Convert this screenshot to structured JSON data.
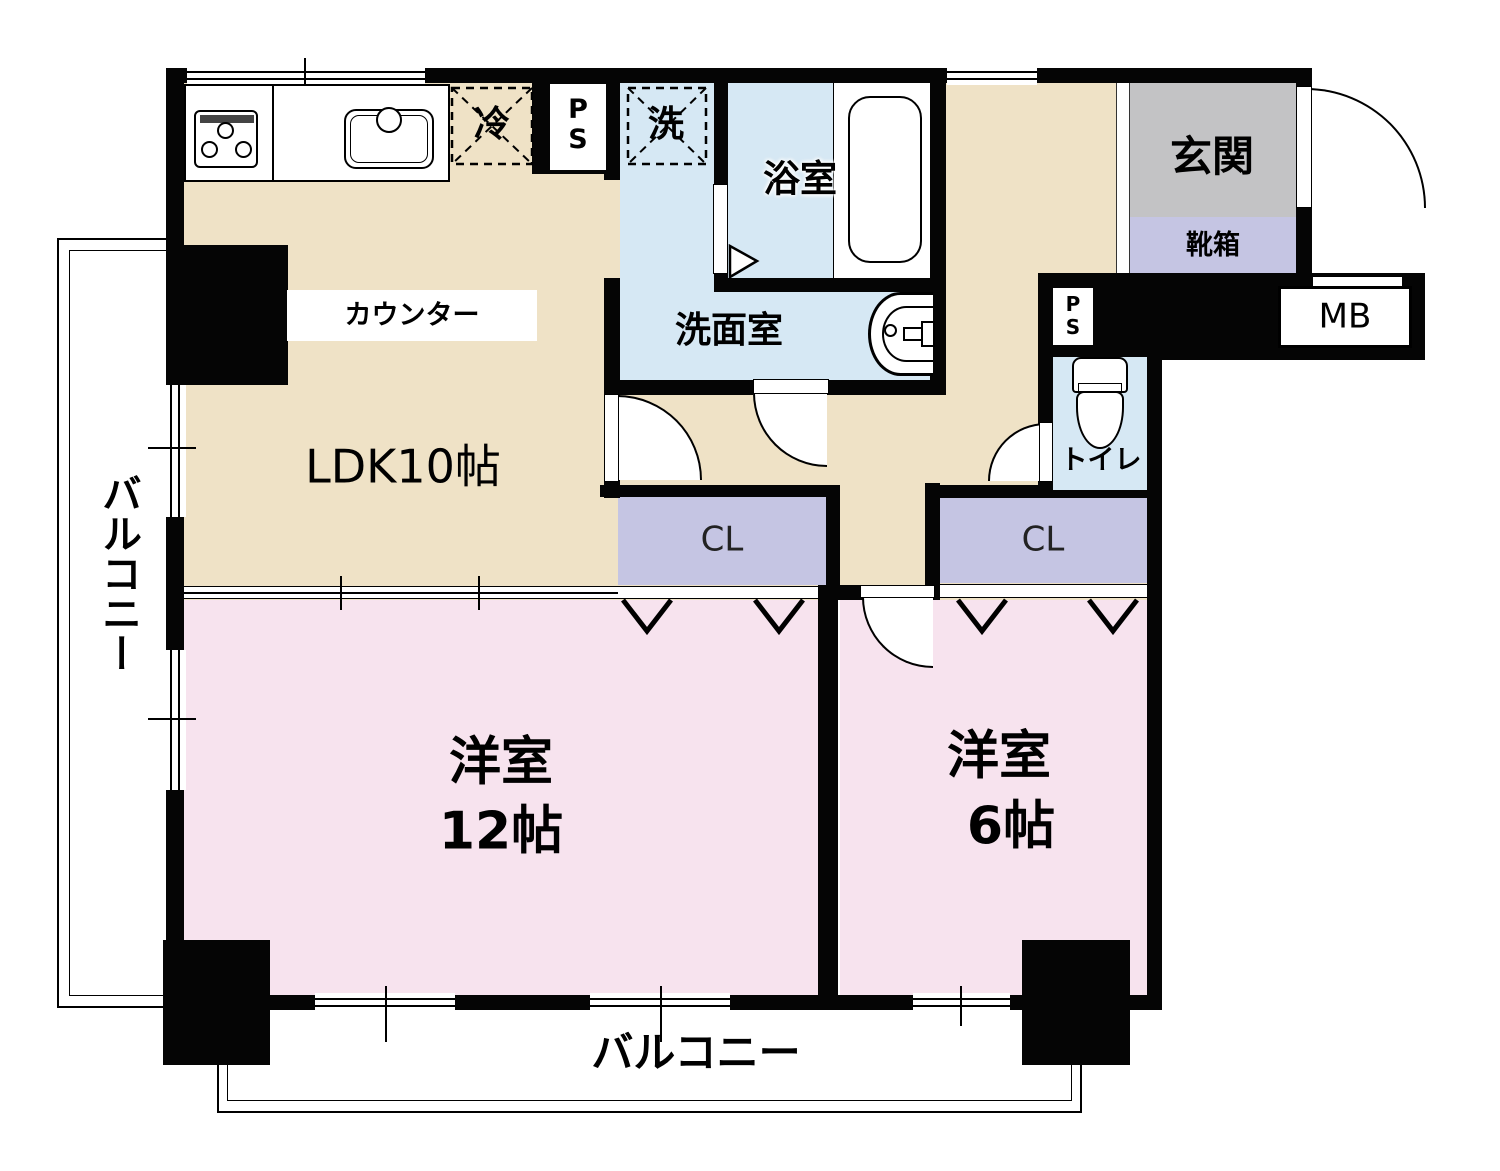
{
  "rooms": {
    "ldk": {
      "label": "LDK10帖"
    },
    "western_12": {
      "line1": "洋室",
      "line2": "12帖"
    },
    "western_6": {
      "line1": "洋室",
      "line2": "6帖"
    },
    "bath": {
      "label": "浴室"
    },
    "washroom": {
      "label": "洗面室"
    },
    "toilet": {
      "label": "トイレ"
    },
    "entrance": {
      "label": "玄関"
    },
    "shoe_box": {
      "label": "靴箱"
    },
    "closet_left": {
      "label": "CL"
    },
    "closet_right": {
      "label": "CL"
    },
    "balcony_left": {
      "label": "バルコニー"
    },
    "balcony_bottom": {
      "label": "バルコニー"
    }
  },
  "fixtures": {
    "counter": {
      "label": "カウンター"
    },
    "refrigerator": {
      "label": "冷"
    },
    "washer": {
      "label": "洗"
    },
    "pipe_space_kitchen": {
      "line1": "P",
      "line2": "S"
    },
    "pipe_space_toilet": {
      "line1": "P",
      "line2": "S"
    },
    "meter_box": {
      "label": "MB"
    }
  },
  "colors": {
    "wall": "#050505",
    "ldk_floor": "#efe2c6",
    "bedroom_floor": "#f7e3ee",
    "wet_area_floor": "#d6e8f4",
    "closet": "#c5c5e3",
    "entrance_floor": "#c3c3c5"
  }
}
